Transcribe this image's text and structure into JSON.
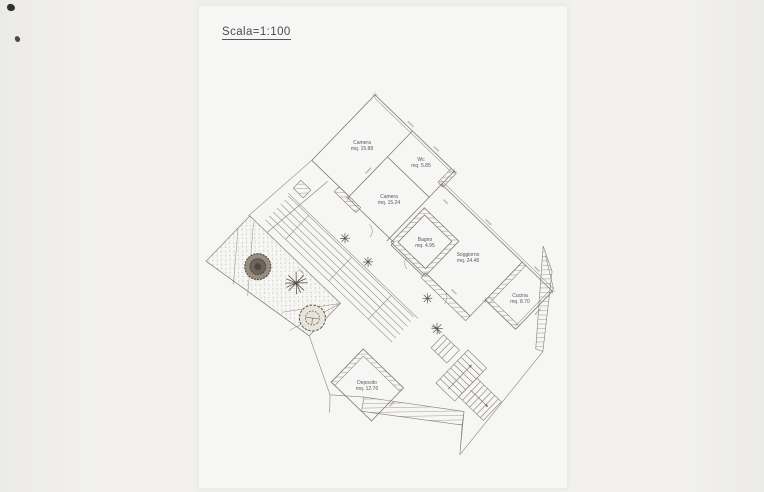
{
  "page": {
    "title": "Scala=1:100",
    "document_type": "architectural floor plan scan"
  },
  "rooms": [
    {
      "name": "Camera",
      "area": "mq. 15.88"
    },
    {
      "name": "Wc",
      "area": "mq. 5.85"
    },
    {
      "name": "Camera",
      "area": "mq. 15.24"
    },
    {
      "name": "Bagno",
      "area": "mq. 4.95"
    },
    {
      "name": "Soggiorno",
      "area": "mq. 24.48"
    },
    {
      "name": "Cucina",
      "area": "mq. 8.70"
    },
    {
      "name": "Deposito",
      "area": "mq. 12.76"
    }
  ],
  "features": [
    "garden-with-trees",
    "terrace-strips",
    "two-stair-flights",
    "hatched-masonry-walls"
  ],
  "colors": {
    "paper": "#f6f6f4",
    "background": "#efeeec",
    "drawing_line": "#847c70",
    "hatch": "#9a9184",
    "label_text": "#585862",
    "title_text": "#4c4c58"
  }
}
